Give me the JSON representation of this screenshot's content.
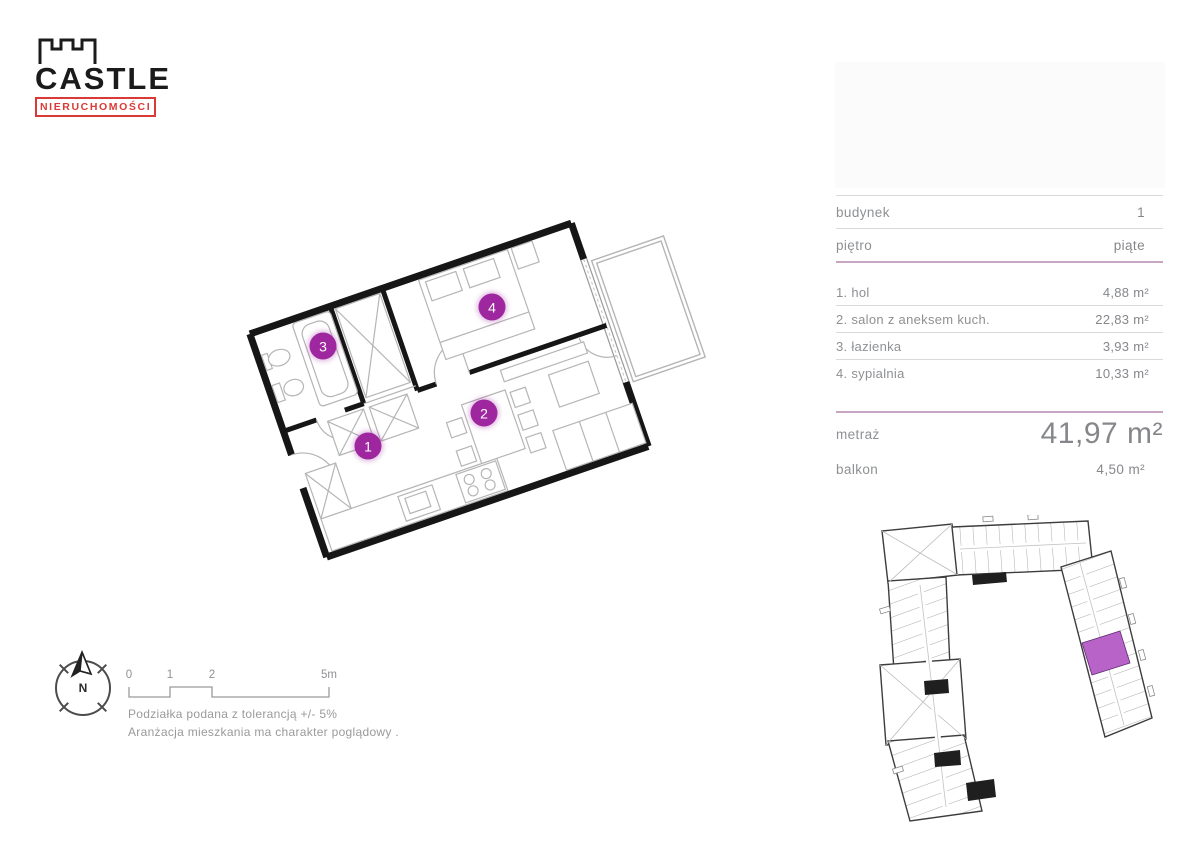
{
  "brand": {
    "name": "CASTLE",
    "subtitle": "NIERUCHOMOŚCI"
  },
  "unit_info": {
    "building_label": "budynek",
    "building_value": "1",
    "floor_label": "piętro",
    "floor_value": "piąte",
    "rooms": [
      {
        "label": "1. hol",
        "area": "4,88 m²"
      },
      {
        "label": "2. salon z aneksem kuch.",
        "area": "22,83 m²"
      },
      {
        "label": "3. łazienka",
        "area": "3,93 m²"
      },
      {
        "label": "4. sypialnia",
        "area": "10,33 m²"
      }
    ],
    "total_label": "metraż",
    "total_value": "41,97 m²",
    "balcony_label": "balkon",
    "balcony_value": "4,50 m²"
  },
  "floorplan": {
    "markers": [
      "1",
      "2",
      "3",
      "4"
    ],
    "marker_color": "#9e27a0"
  },
  "site_plan": {
    "highlight_color": "#b863c8"
  },
  "legend": {
    "compass_label": "N",
    "scale_ticks": [
      "0",
      "1",
      "2",
      "5m"
    ],
    "note_tolerance": "Podziałka podana z tolerancją +/- 5%",
    "note_arrangement": "Aranżacja mieszkania ma charakter poglądowy ."
  },
  "colors": {
    "divider_pink": "#c7a6c3",
    "logo_red": "#d93a36"
  }
}
